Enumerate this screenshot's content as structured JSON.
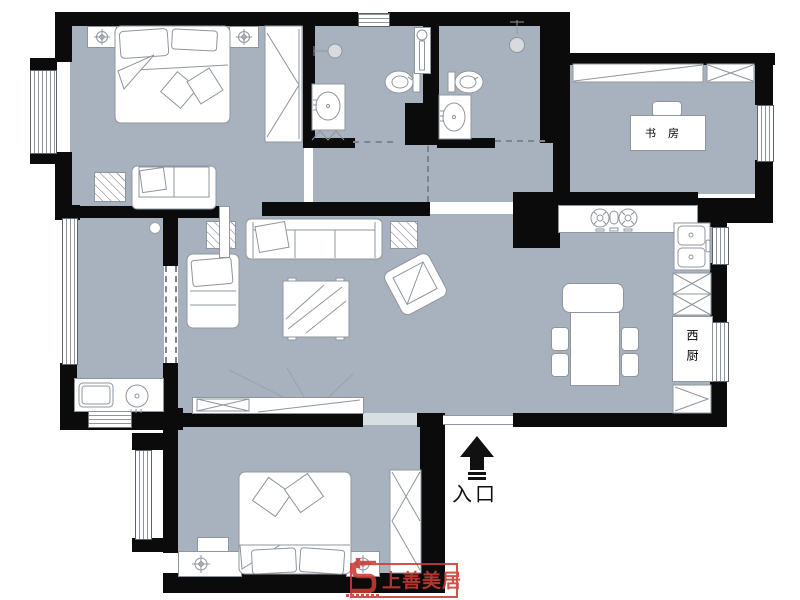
{
  "document": {
    "kind": "apartment floor plan drawing"
  },
  "colors": {
    "floor": "#a8b2bf",
    "wall": "#0b0b0b",
    "furniture_stroke": "#8f959c",
    "fixture_fill": "#d7dade",
    "logo_red": "#cc3b33"
  },
  "labels": {
    "study": "书房",
    "west_kitchen": "西厨",
    "entrance": "入口",
    "logo": "上善美居"
  },
  "icons": {
    "entrance_arrow": "arrow-up",
    "nightstand_marker": "compass-cross",
    "stove": "two-burner-gas-hob",
    "sink": "double-basin-sink",
    "toilet": "toilet-oval",
    "shower": "shower-head",
    "washer": "washing-machine-circle"
  }
}
